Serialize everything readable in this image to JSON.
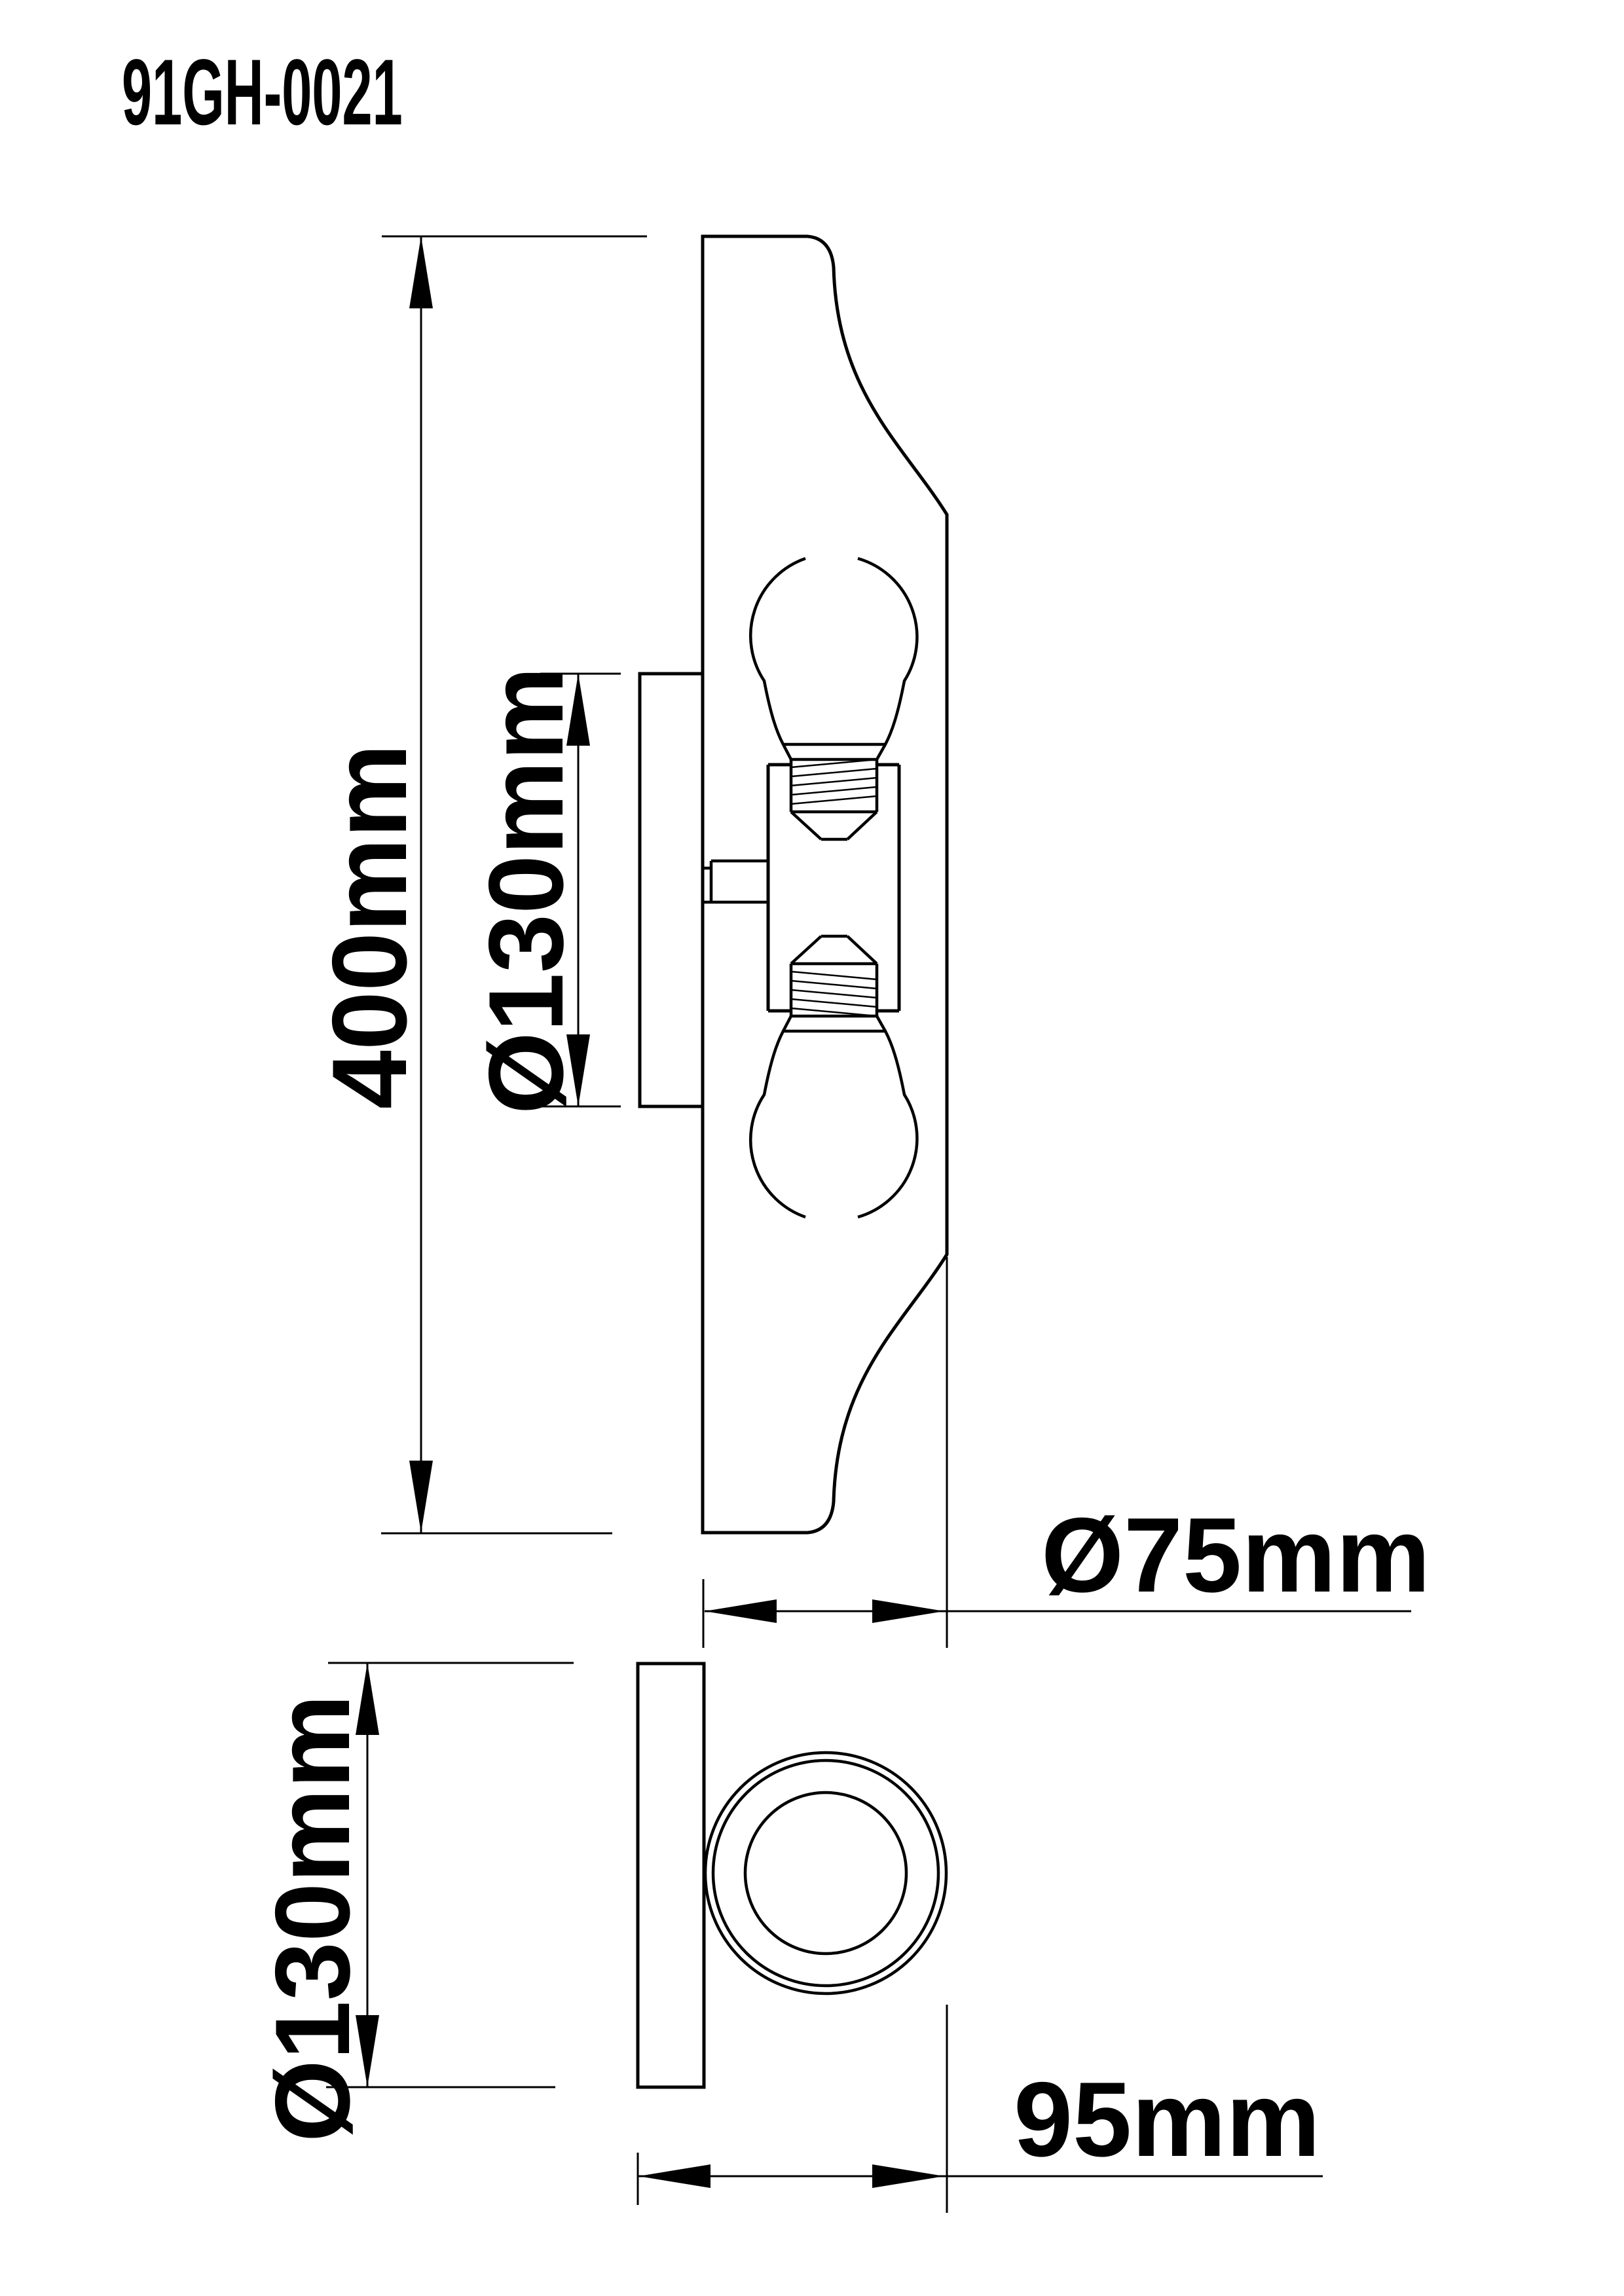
{
  "colors": {
    "ink": "#000000",
    "paper": "#ffffff"
  },
  "header": {
    "model_number": "91GH-0021"
  },
  "side_view": {
    "description": "side elevation of two-bulb ceiling/wall light",
    "dimensions": {
      "overall_height": "400mm",
      "backplate_diameter": "Ø130mm",
      "canopy_depth": "Ø75mm"
    }
  },
  "bottom_view": {
    "description": "end profile with mounting plate and cylinder",
    "dimensions": {
      "plate_diameter": "Ø130mm",
      "overall_depth": "95mm"
    }
  }
}
